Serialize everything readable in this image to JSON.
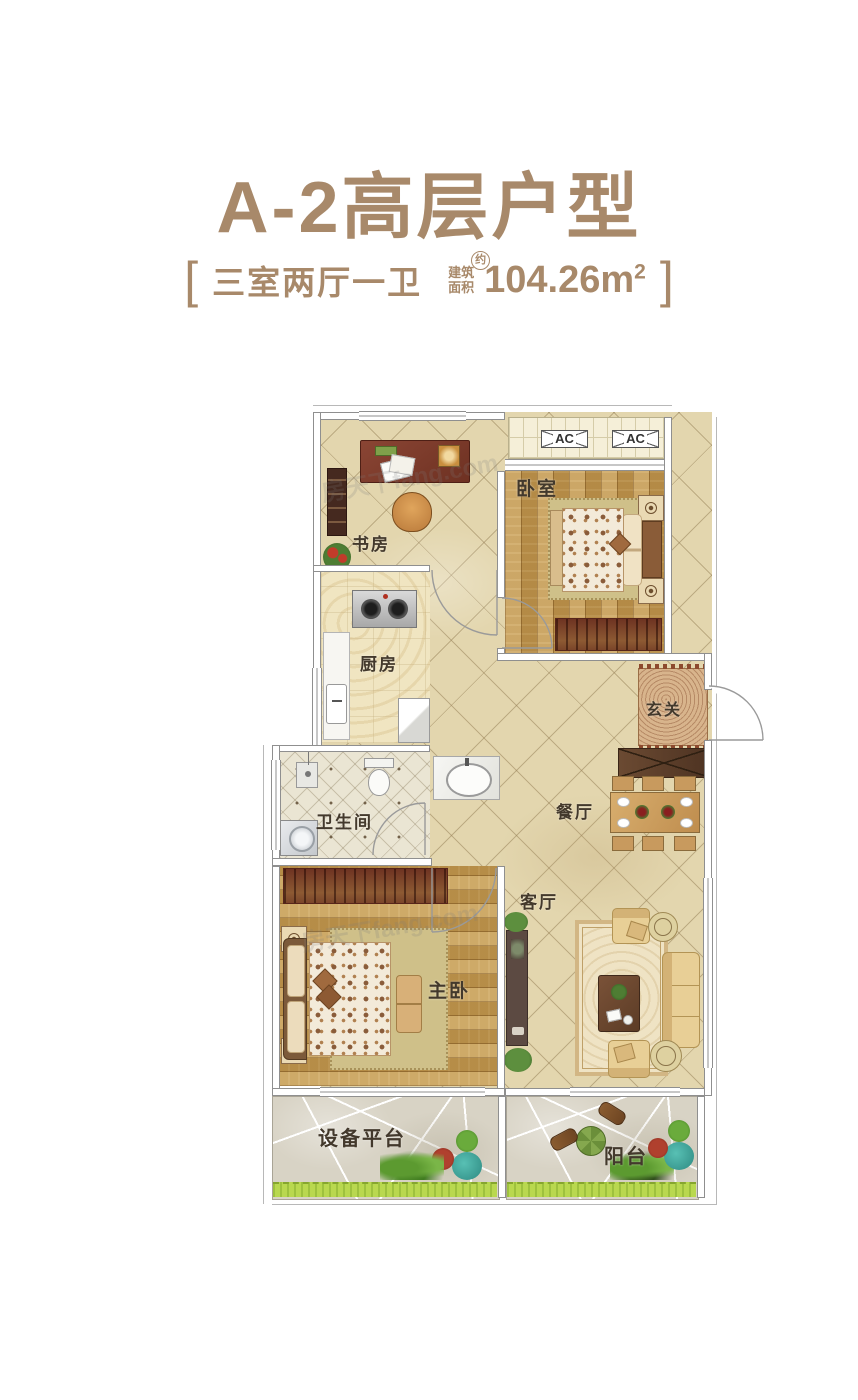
{
  "header": {
    "title": "A-2高层户型",
    "spec": {
      "bracket_left": "[",
      "bracket_right": "]",
      "rooms_text": "三室两厅一卫",
      "area_label_top": "建筑",
      "area_label_bottom": "面积",
      "area_approx": "约",
      "area_value": "104.26m",
      "area_sup": "2"
    }
  },
  "floorplan": {
    "rooms": [
      {
        "label": "书房"
      },
      {
        "label": "卧室"
      },
      {
        "label": "厨房"
      },
      {
        "label": "玄关"
      },
      {
        "label": "餐厅"
      },
      {
        "label": "卫生间"
      },
      {
        "label": "主卧"
      },
      {
        "label": "客厅"
      },
      {
        "label": "设备平台"
      },
      {
        "label": "阳台"
      }
    ],
    "ac_units": [
      {
        "label": "AC"
      },
      {
        "label": "AC"
      }
    ],
    "watermark": "房天下fang.com"
  },
  "colors": {
    "accent_brown": "#a8896a",
    "label_dark": "#43392c",
    "tile_beige": "#e3d6ae",
    "wood": "#c59a50",
    "stone_gray": "#d8d3c5",
    "grass_green": "#b9d84f"
  }
}
